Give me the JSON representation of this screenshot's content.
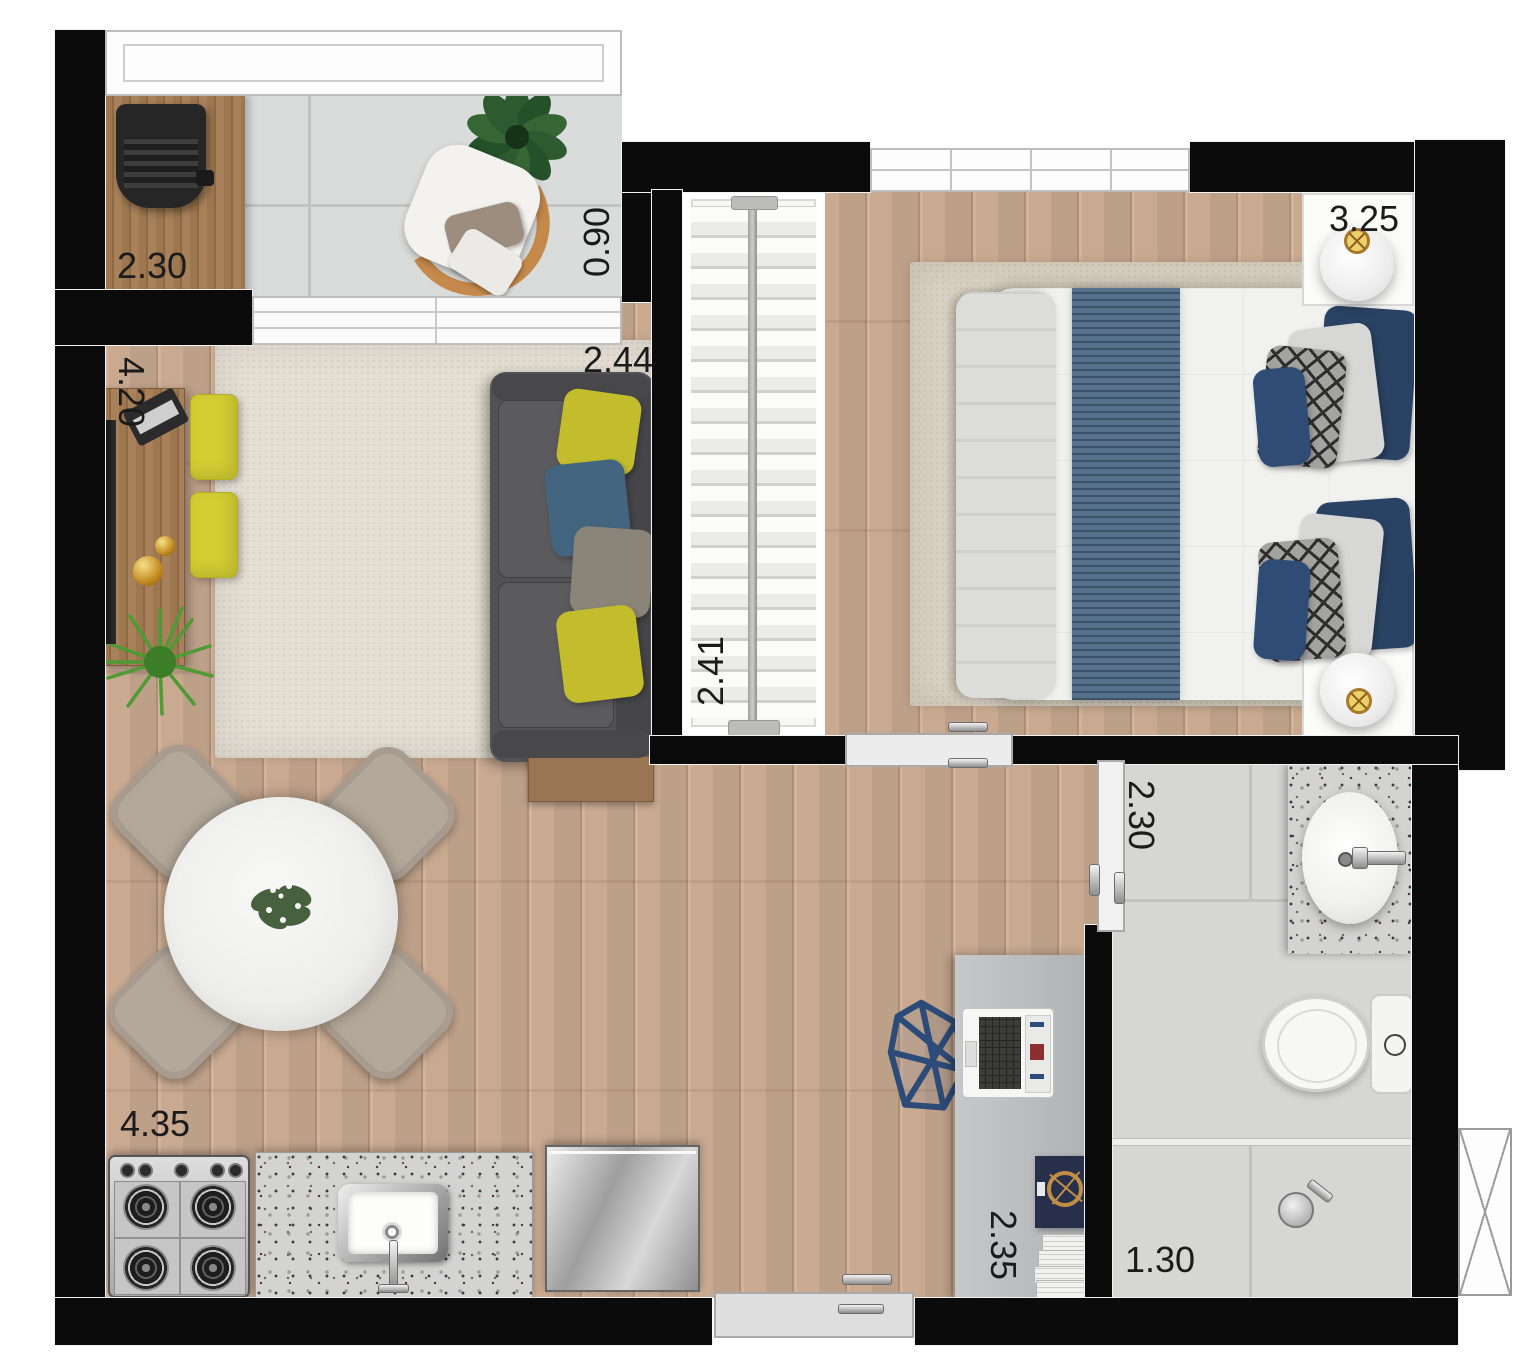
{
  "plan": {
    "type": "residential-floor-plan",
    "unit": "meters",
    "dimensions": {
      "balcony_counter": "2.30",
      "balcony_depth": "0.90",
      "living_length": "4.20",
      "living_width": "2.44",
      "bedroom_width": "3.25",
      "wardrobe_length": "2.41",
      "bathroom_length": "2.30",
      "kitchen_wall": "4.35",
      "desk_wall": "2.35",
      "shower_width": "1.30"
    },
    "rooms": [
      {
        "name": "balcony",
        "furniture": [
          "barbecue-grill",
          "wood-counter",
          "potted-plant",
          "lounge-chair"
        ]
      },
      {
        "name": "living-room",
        "furniture": [
          "tv-console",
          "flat-screen-tv",
          "clock-radio",
          "decor-spheres",
          "pouf",
          "pouf",
          "grass-plant",
          "sofa",
          "throw-pillows",
          "side-table",
          "area-rug"
        ]
      },
      {
        "name": "dining",
        "furniture": [
          "round-marble-table",
          "dining-chair",
          "dining-chair",
          "dining-chair",
          "dining-chair",
          "centerpiece-plant"
        ]
      },
      {
        "name": "bedroom",
        "furniture": [
          "open-wardrobe-hangers",
          "double-bed",
          "bed-runner",
          "pillows",
          "nightstand",
          "table-lamp",
          "nightstand",
          "table-lamp",
          "area-rug"
        ]
      },
      {
        "name": "home-office",
        "furniture": [
          "desk",
          "laptop",
          "desk-chair",
          "decor-book",
          "paper-stack"
        ]
      },
      {
        "name": "bathroom",
        "furniture": [
          "vanity-granite-counter",
          "oval-sink",
          "faucet",
          "toilet",
          "shower-head",
          "glass-partition",
          "shaft-window"
        ]
      },
      {
        "name": "kitchen",
        "furniture": [
          "gas-stove",
          "granite-countertop",
          "kitchen-sink",
          "refrigerator"
        ]
      }
    ],
    "doors": [
      "balcony-sliding-door",
      "bedroom-sliding-door",
      "bathroom-sliding-door",
      "entry-door"
    ],
    "colors": {
      "wall": "#0b0b0b",
      "wood_floor": "#c9aa91",
      "balcony_tile": "#dadbdb",
      "living_rug": "#e4ded3",
      "bedroom_rug": "#d9d1c2",
      "sofa_gray": "#57575a",
      "accent_yellow": "#cdc32f",
      "accent_blue": "#44657f",
      "bed_runner_blue": "#56718c",
      "navy_pillow": "#2a4263",
      "desk_chair_blue": "#2d4b78",
      "lamp_gold": "#b98a3c",
      "wood_furniture": "#9a7553"
    }
  }
}
